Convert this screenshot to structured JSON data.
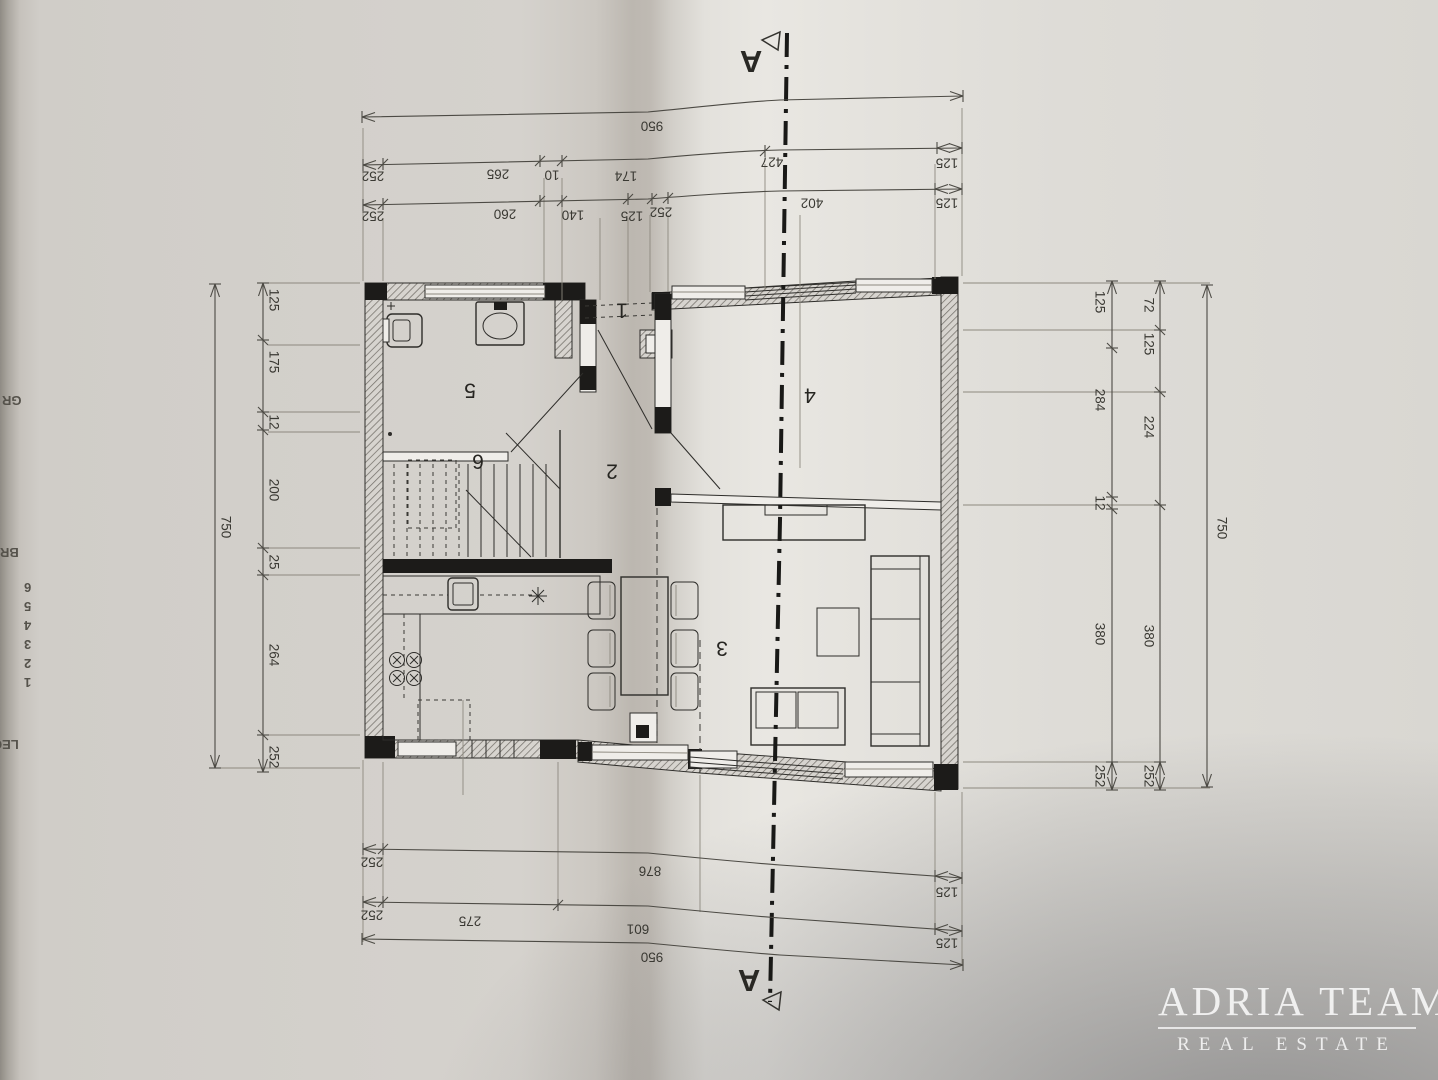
{
  "watermark": {
    "line1": "ADRIA TEAM",
    "line2": "REAL ESTATE"
  },
  "section_marker": {
    "top": "A",
    "bottom": "A"
  },
  "rooms": {
    "r1": "1",
    "r2": "2",
    "r3": "3",
    "r4": "4",
    "r5": "5",
    "r6": "6"
  },
  "dims": {
    "top_overall": "950",
    "top_row2": [
      "252",
      "265",
      "10",
      "174",
      "427",
      "125"
    ],
    "top_row3": [
      "252",
      "260",
      "140",
      "125",
      "252",
      "402",
      "125"
    ],
    "bottom_row1": [
      "252",
      "876",
      "125"
    ],
    "bottom_row2": [
      "252",
      "275",
      "601",
      "125"
    ],
    "bottom_overall": "950",
    "left_chain": [
      "125",
      "175",
      "12",
      "200",
      "25",
      "264",
      "252"
    ],
    "left_overall": "750",
    "right_inner": [
      "125",
      "284",
      "12",
      "380",
      "252"
    ],
    "right_middle": [
      "72",
      "125",
      "224",
      "380",
      "252"
    ],
    "right_overall": "750"
  },
  "edge_legend": {
    "items": [
      "GR",
      "BR",
      "6",
      "5",
      "4",
      "3",
      "2",
      "1",
      "LEG"
    ]
  }
}
